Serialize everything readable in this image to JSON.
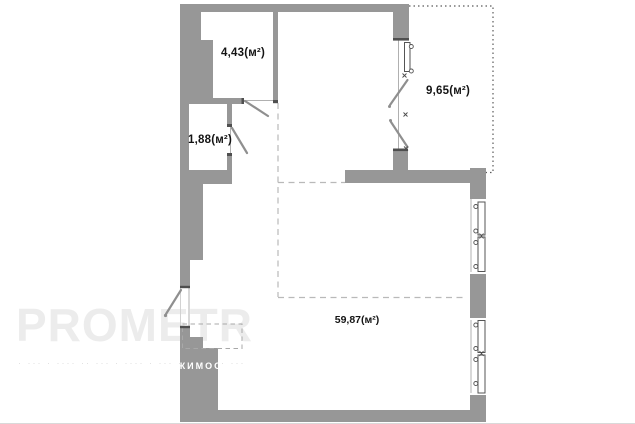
{
  "plan": {
    "kind": "apartment-floor-plan",
    "rooms": [
      {
        "id": "room-top-left",
        "area_label": "4,43(м²)"
      },
      {
        "id": "room-wc",
        "area_label": "1,88(м²)"
      },
      {
        "id": "balcony",
        "area_label": "9,65(м²)"
      },
      {
        "id": "main-room",
        "area_label": "59,87(м²)"
      }
    ]
  },
  "watermark": {
    "brand": "PROMETR",
    "tagline_fragment": "ЖИМОС",
    "tagline_dots_left": "· ··· · ···· ·· ··· · ···· · ··· ··",
    "tagline_dots_right": "· ···"
  },
  "colors": {
    "wall": "#979797",
    "thin_line": "#555555",
    "zone_dash": "#b9b9b9",
    "label_text": "#141414",
    "watermark": "#ececec"
  }
}
